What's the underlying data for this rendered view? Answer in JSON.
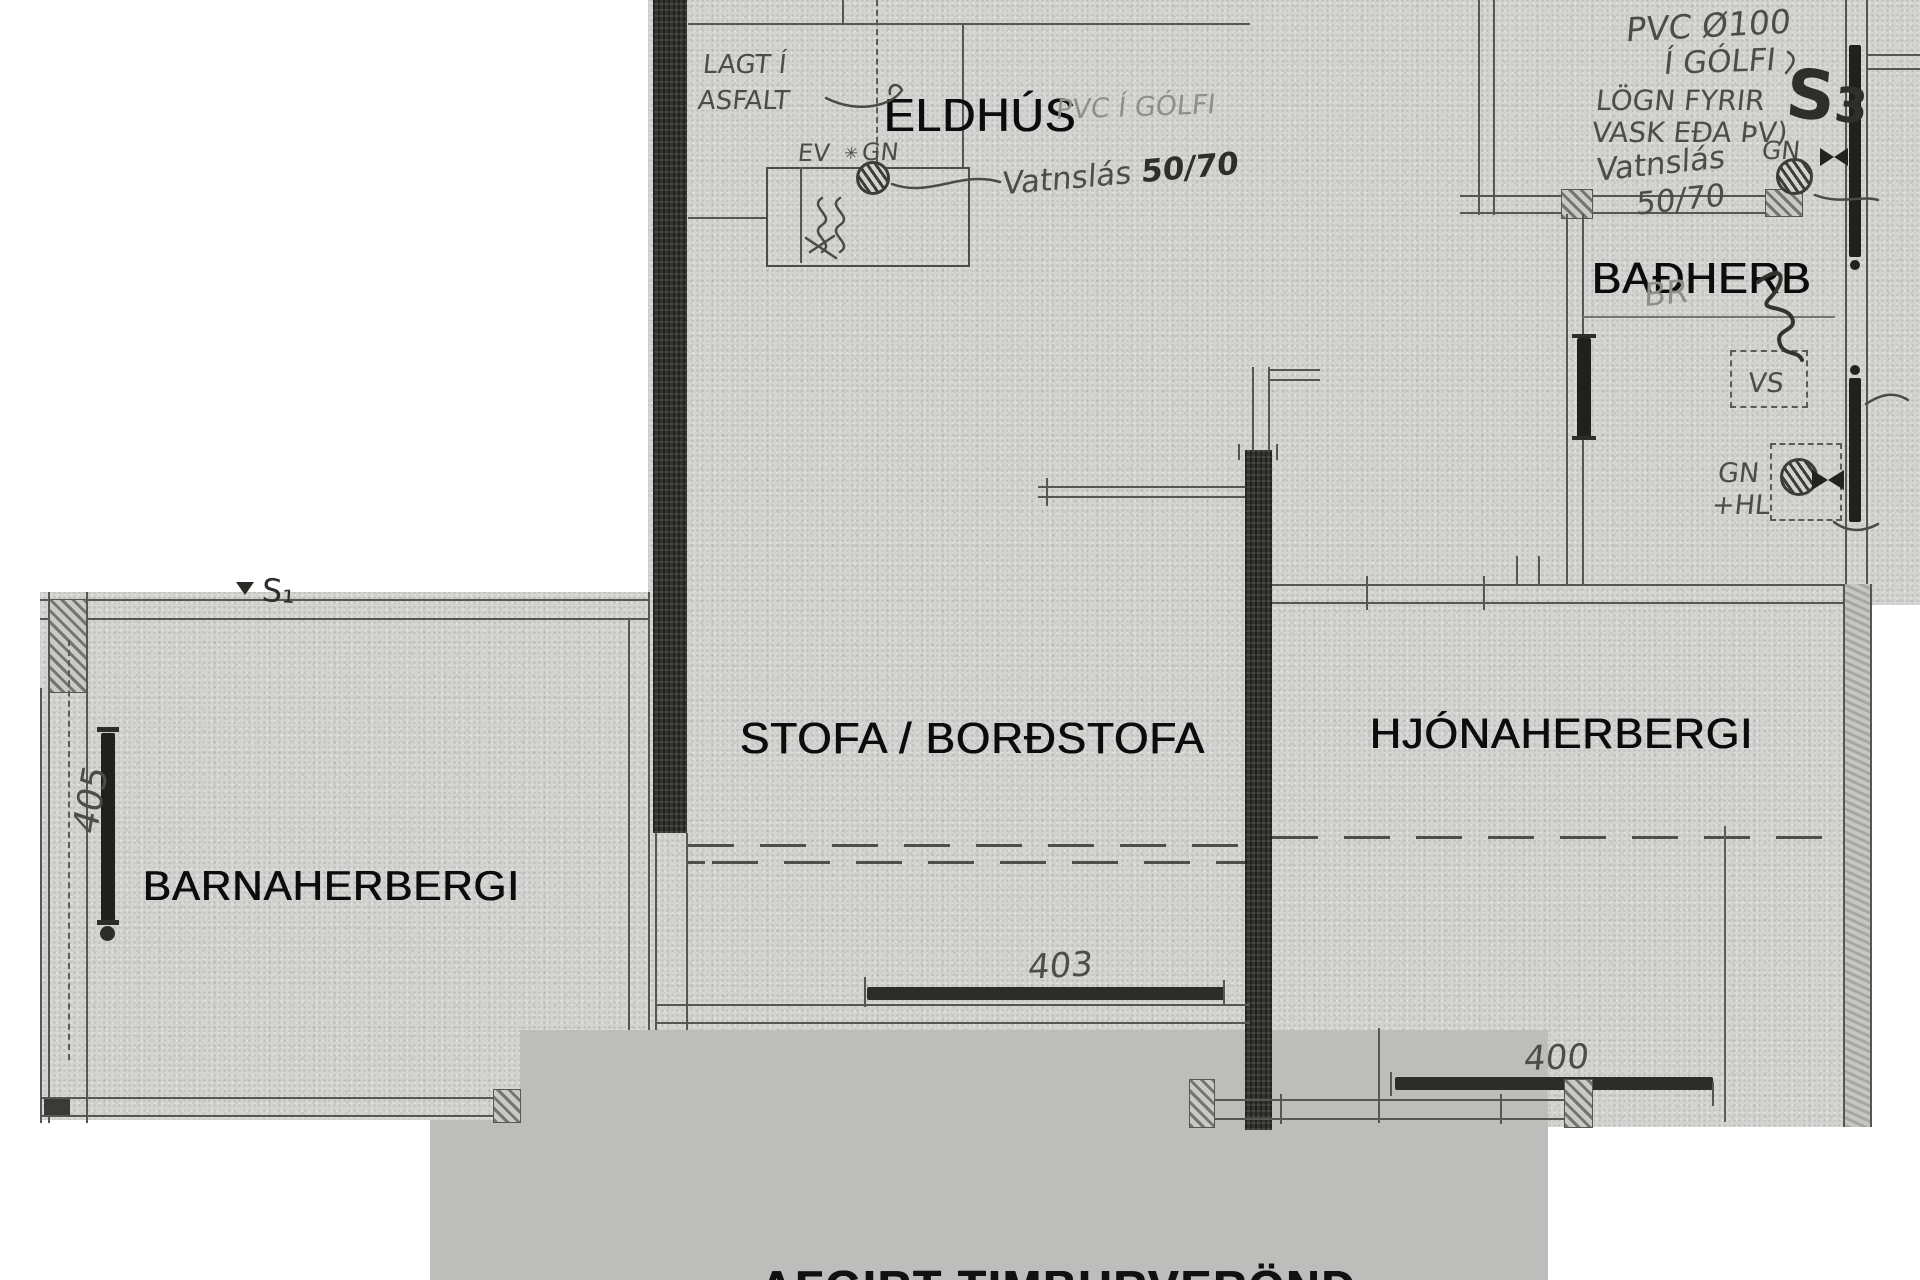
{
  "rooms": {
    "eldhus": "ELDHÚS",
    "badherb": "BAÐHERB",
    "stofa": "STOFA / BORÐSTOFA",
    "hjonaherbergi": "HJÓNAHERBERGI",
    "barnaherbergi": "BARNAHERBERGI"
  },
  "hand": {
    "lagt_i": "LAGT Í",
    "asfalt": "ASFALT",
    "ev": "EV",
    "star": "✳",
    "gn_kitchen": "GN",
    "pvc_i_golfi": "PVC Í GÓLFI",
    "vatnslas_kitchen": "Vatnslás",
    "size_kitchen": "50/70",
    "pvc_o100": "PVC Ø100",
    "i_golfi": "Í GÓLFI",
    "logn_fyrir": "LÖGN FYRIR",
    "vask_eda_thv": "VASK EÐA ÞV)",
    "s3_s": "S",
    "s3_3": "3",
    "gn_top": "GN",
    "vatnslas_right": "Vatnslás",
    "size_right": "50/70",
    "br": "BR",
    "vs": "VS",
    "gn_bath": "GN",
    "hl": "+HL",
    "s1": "S₁"
  },
  "dims": {
    "d405": "405",
    "d403": "403",
    "d400": "400"
  },
  "deck": {
    "label": "AFGIRT TIMBURVERÖND"
  }
}
